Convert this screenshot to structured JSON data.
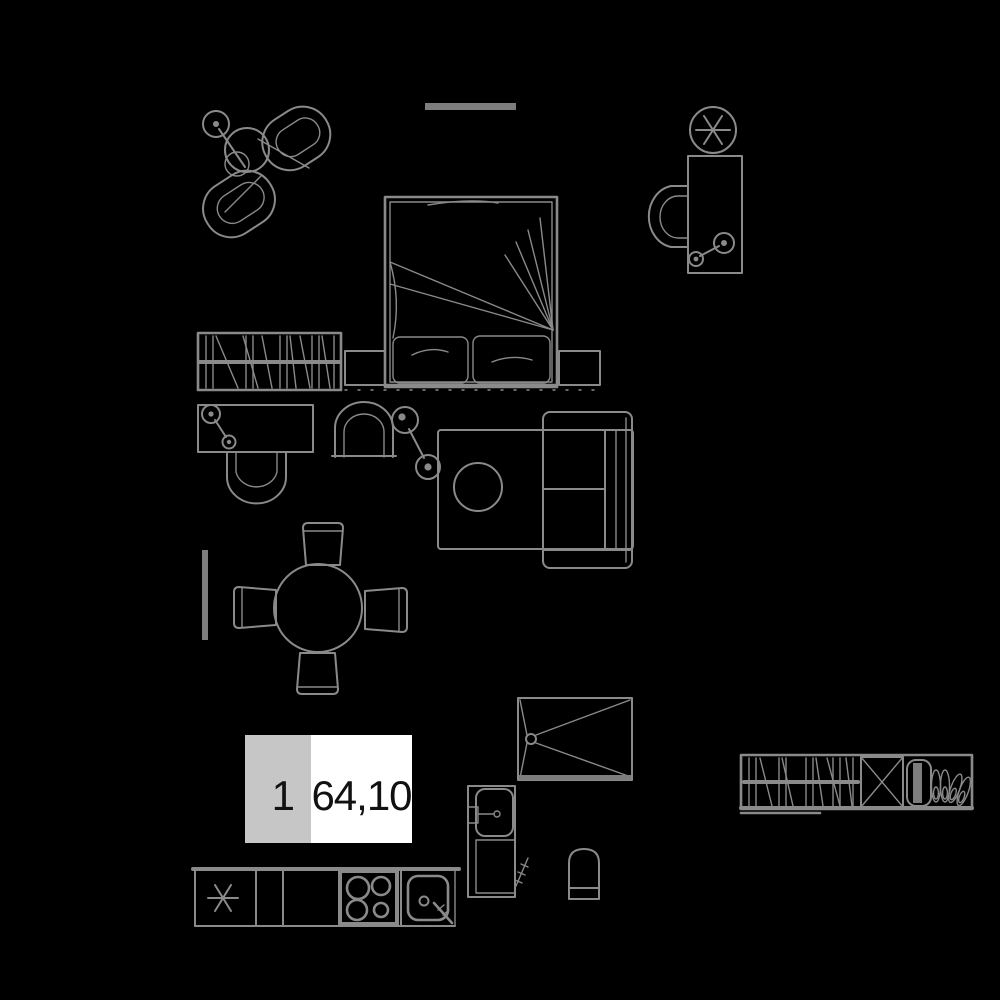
{
  "page": {
    "title": "apartment-floor-plan"
  },
  "unit_label": {
    "rooms": "1",
    "area": "64,10"
  },
  "colors": {
    "bg": "#000000",
    "line": "#8a8a8a",
    "solid": "#7d7d7d",
    "label-gray": "#c6c6c6",
    "label-white": "#ffffff",
    "label-text": "#111111"
  },
  "icons": [
    "plant-icon",
    "window-icon",
    "bed-icon",
    "nightstand-icon",
    "wardrobe-icon",
    "desk-icon",
    "chair-icon",
    "table-lamp-icon",
    "pendant-light-icon",
    "armchair-icon",
    "floor-lamp-icon",
    "rug-icon",
    "coffee-table-icon",
    "sofa-icon",
    "dining-table-icon",
    "dining-chair-icon",
    "shower-icon",
    "washbasin-icon",
    "toilet-icon",
    "fridge-icon",
    "stove-icon",
    "kitchen-sink-icon",
    "hall-wardrobe-icon",
    "shoes-icon"
  ]
}
